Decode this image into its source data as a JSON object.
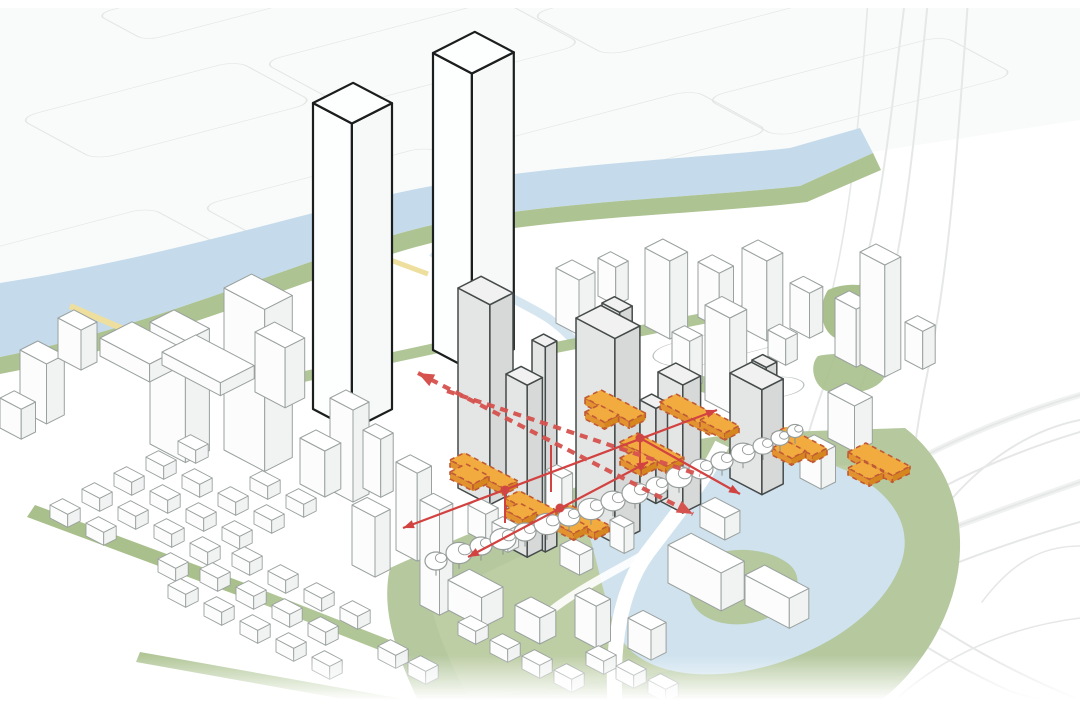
{
  "meta": {
    "title": "urban-design axonometric massing diagram",
    "description": "aerial axonometric of riverfront district: proposed grey towers with orange podium plates, red circulation arrows, river, waterfront park, pond and highway interchange"
  },
  "colors": {
    "paper": "#ffffff",
    "paper_tint": "#f7f9f8",
    "faint_line": "#e3e6e4",
    "faint_line2": "#eceeed",
    "context_stroke": "#9aa19f",
    "context_dark": "#6f7574",
    "white_top": "#ffffff",
    "white_left": "#fbfcfb",
    "white_right": "#f1f3f2",
    "black_stroke": "#1b1e1e",
    "black_fill": "#fdfefe",
    "gray_top": "#f0f1f0",
    "gray_left": "#e3e6e4",
    "gray_right": "#d6d9d7",
    "gray_stroke": "#454a4a",
    "orange_top": "#f2ab3f",
    "orange_left": "#e29330",
    "orange_right": "#d5861f",
    "orange_stroke": "#c05a36",
    "red_solid": "#d24240",
    "red_dash": "#d6524e",
    "red_dot": "#cf4643",
    "river": "#c5dbeb",
    "pond": "#cfe2ee",
    "canal": "#cfe2ee",
    "green": "#a9c08c",
    "green_light": "#c3d2a9",
    "green_field": "#b5c89e",
    "tree_stroke": "#979d9b",
    "trunk": "#8a918f",
    "yellow": "#eedf9e",
    "path_white": "#ffffff"
  },
  "diagram": {
    "black_towers": [
      [
        313,
        103,
        44,
        45,
        306
      ],
      [
        433,
        53,
        44,
        47,
        297
      ]
    ],
    "context_back": [
      [
        556,
        268,
        26,
        18,
        55
      ],
      [
        598,
        258,
        20,
        14,
        38
      ],
      [
        645,
        248,
        28,
        20,
        78
      ],
      [
        698,
        262,
        24,
        16,
        55
      ],
      [
        742,
        248,
        28,
        18,
        80
      ],
      [
        790,
        283,
        22,
        15,
        45
      ],
      [
        835,
        298,
        24,
        16,
        58
      ],
      [
        768,
        330,
        20,
        13,
        26
      ],
      [
        860,
        252,
        28,
        18,
        112
      ],
      [
        905,
        322,
        20,
        14,
        38
      ],
      [
        705,
        305,
        28,
        19,
        95
      ],
      [
        672,
        332,
        20,
        14,
        48
      ],
      [
        828,
        392,
        30,
        20,
        46
      ],
      [
        800,
        442,
        24,
        16,
        36
      ],
      [
        150,
        322,
        40,
        27,
        122
      ],
      [
        224,
        288,
        46,
        31,
        162
      ],
      [
        255,
        332,
        34,
        22,
        60
      ],
      [
        100,
        338,
        56,
        36,
        18
      ],
      [
        162,
        352,
        66,
        38,
        13
      ],
      [
        20,
        350,
        30,
        20,
        60
      ],
      [
        0,
        398,
        24,
        16,
        30
      ],
      [
        58,
        318,
        26,
        18,
        40
      ]
    ],
    "context_front": [
      [
        330,
        398,
        26,
        18,
        92
      ],
      [
        300,
        438,
        28,
        18,
        46
      ],
      [
        363,
        430,
        20,
        14,
        58
      ],
      [
        396,
        462,
        24,
        16,
        88
      ],
      [
        352,
        505,
        26,
        17,
        60
      ],
      [
        420,
        500,
        22,
        15,
        105
      ],
      [
        448,
        580,
        38,
        24,
        30
      ],
      [
        515,
        605,
        28,
        18,
        26
      ],
      [
        575,
        595,
        24,
        16,
        42
      ],
      [
        628,
        618,
        26,
        17,
        30
      ],
      [
        668,
        545,
        60,
        26,
        38
      ],
      [
        745,
        575,
        50,
        22,
        30
      ],
      [
        700,
        505,
        28,
        17,
        22
      ]
    ],
    "village": [
      [
        50,
        505
      ],
      [
        86,
        523
      ],
      [
        158,
        559
      ],
      [
        82,
        489
      ],
      [
        118,
        507
      ],
      [
        154,
        525
      ],
      [
        190,
        543
      ],
      [
        114,
        473
      ],
      [
        150,
        491
      ],
      [
        186,
        509
      ],
      [
        222,
        527
      ],
      [
        146,
        457
      ],
      [
        182,
        475
      ],
      [
        218,
        493
      ],
      [
        254,
        511
      ],
      [
        178,
        441
      ],
      [
        250,
        477
      ],
      [
        286,
        495
      ],
      [
        168,
        585
      ],
      [
        204,
        603
      ],
      [
        240,
        621
      ],
      [
        276,
        639
      ],
      [
        200,
        569
      ],
      [
        236,
        587
      ],
      [
        272,
        605
      ],
      [
        308,
        623
      ],
      [
        232,
        553
      ],
      [
        268,
        571
      ],
      [
        304,
        589
      ],
      [
        340,
        607
      ],
      [
        312,
        657
      ],
      [
        378,
        646
      ],
      [
        408,
        662
      ],
      [
        458,
        622
      ],
      [
        490,
        640
      ],
      [
        522,
        656
      ],
      [
        554,
        670
      ],
      [
        586,
        652
      ],
      [
        616,
        666
      ],
      [
        648,
        680
      ]
    ],
    "gray_towers": [
      [
        458,
        288,
        36,
        26,
        200
      ],
      [
        602,
        303,
        20,
        14,
        36
      ],
      [
        576,
        318,
        44,
        28,
        205
      ],
      [
        532,
        340,
        15,
        13,
        205
      ],
      [
        752,
        360,
        16,
        12,
        26
      ],
      [
        506,
        374,
        24,
        17,
        172
      ],
      [
        658,
        372,
        28,
        20,
        128
      ],
      [
        730,
        373,
        36,
        24,
        105
      ],
      [
        640,
        400,
        18,
        13,
        95
      ]
    ],
    "site_front_whites": [
      [
        468,
        505,
        20,
        14,
        28
      ],
      [
        492,
        522,
        18,
        12,
        22
      ],
      [
        546,
        470,
        18,
        12,
        40
      ],
      [
        610,
        520,
        16,
        11,
        26
      ],
      [
        560,
        545,
        22,
        15,
        20
      ]
    ],
    "orange_plates": [
      [
        450,
        460,
        60,
        16
      ],
      [
        450,
        472,
        26,
        18
      ],
      [
        505,
        498,
        48,
        16
      ],
      [
        505,
        510,
        20,
        16
      ],
      [
        556,
        512,
        44,
        16
      ],
      [
        556,
        524,
        20,
        16
      ],
      [
        585,
        398,
        50,
        18
      ],
      [
        585,
        412,
        22,
        16
      ],
      [
        660,
        402,
        56,
        18
      ],
      [
        700,
        420,
        28,
        16
      ],
      [
        620,
        442,
        52,
        20
      ],
      [
        620,
        458,
        24,
        18
      ],
      [
        772,
        434,
        46,
        16
      ],
      [
        772,
        448,
        22,
        16
      ],
      [
        848,
        452,
        50,
        20
      ],
      [
        848,
        468,
        24,
        16
      ]
    ],
    "solid_arrows": [
      [
        403,
        528,
        717,
        410,
        1,
        1
      ],
      [
        468,
        557,
        648,
        462,
        1,
        1
      ],
      [
        640,
        438,
        740,
        494,
        0,
        1
      ]
    ],
    "vertical_links": [
      [
        505,
        490,
        505,
        523
      ],
      [
        640,
        438,
        640,
        466
      ],
      [
        551,
        445,
        551,
        492
      ]
    ],
    "arrow_dots": [
      [
        505,
        490
      ],
      [
        640,
        438
      ],
      [
        560,
        508
      ]
    ],
    "dashed_arrows": [
      [
        418,
        373,
        693,
        514,
        1,
        1
      ],
      [
        447,
        391,
        700,
        475,
        0,
        0
      ]
    ],
    "trees": [
      [
        436,
        561,
        11
      ],
      [
        459,
        553,
        13
      ],
      [
        481,
        546,
        11
      ],
      [
        503,
        539,
        13
      ],
      [
        525,
        532,
        11
      ],
      [
        547,
        524,
        13
      ],
      [
        569,
        517,
        11
      ],
      [
        591,
        509,
        13
      ],
      [
        613,
        501,
        12
      ],
      [
        635,
        493,
        13
      ],
      [
        657,
        486,
        11
      ],
      [
        679,
        477,
        13
      ],
      [
        701,
        469,
        12
      ],
      [
        722,
        461,
        11
      ],
      [
        743,
        453,
        12
      ],
      [
        763,
        446,
        10
      ],
      [
        780,
        438,
        9
      ],
      [
        795,
        431,
        8
      ]
    ]
  }
}
